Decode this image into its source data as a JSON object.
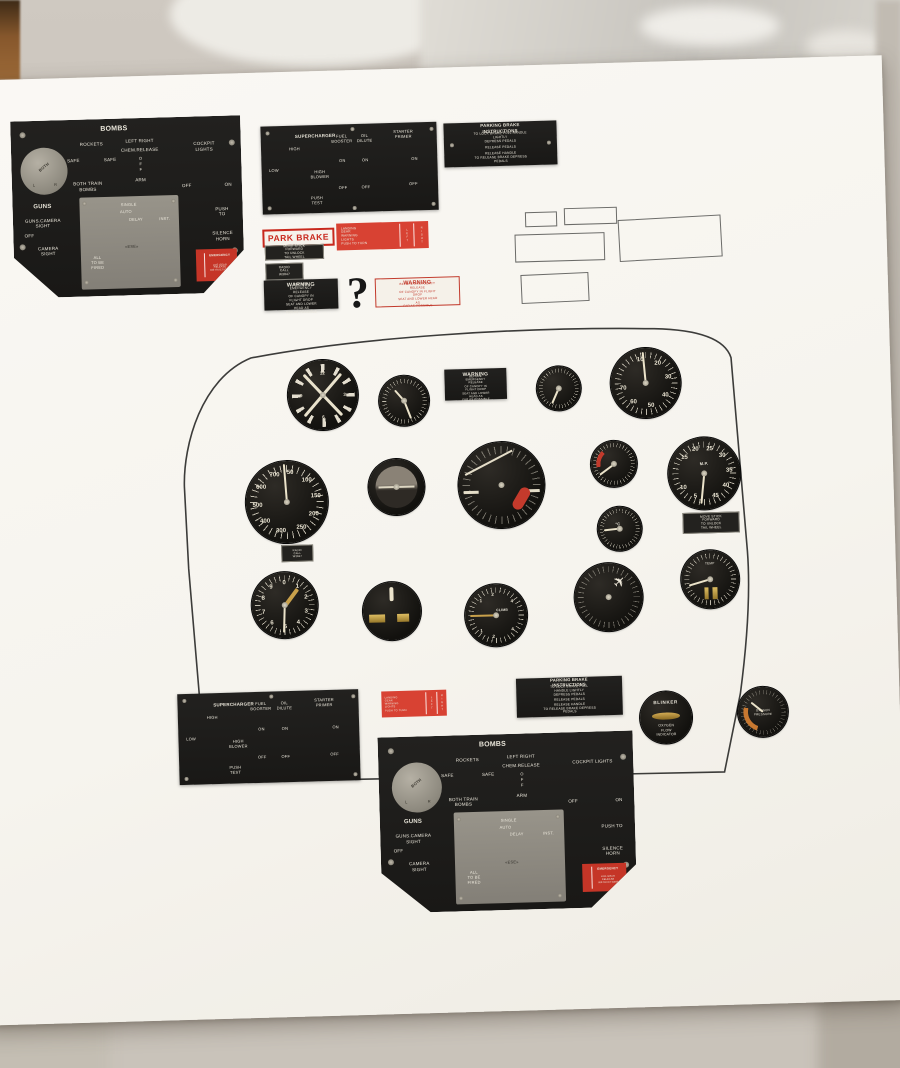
{
  "colors": {
    "panel_black": "#1b1a18",
    "placard_red": "#d84233",
    "warning_red": "#c23a2c",
    "paper": "#f6f4ee",
    "gold": "#c9a14b"
  },
  "labels": {
    "bombs": {
      "title": "BOMBS",
      "rockets": "ROCKETS",
      "left_right": "LEFT    RIGHT",
      "chem_release": "CHEM.RELEASE",
      "cockpit_lights": "COCKPIT LIGHTS",
      "safe_a": "SAFE",
      "safe_b": "SAFE",
      "off_stack": "OFF",
      "arm": "ARM",
      "both_train": "BOTH TRAIN\nBOMBS",
      "off_a": "OFF",
      "on_a": "ON",
      "knob_center": "BOTH",
      "knob_l": "L",
      "knob_r": "R",
      "guns": "GUNS",
      "guns_camera": "GUNS.CAMERA\nSIGHT",
      "off_b": "OFF",
      "camera_sight": "CAMERA\nSIGHT",
      "single": "SINGLE",
      "auto": "AUTO",
      "delay": "DELAY",
      "inst": "INST.",
      "center_mark": "«ESE»",
      "all_fired": "ALL\nTO BE\nFIRED",
      "push_to": "PUSH TO",
      "silence": "SILENCE\nHORN",
      "emergency_title": "EMERGENCY",
      "emergency_lines": "LDG GEAR\nRELEASE\nINSTRUCTIONS"
    },
    "supercharger": {
      "title": "SUPERCHARGER",
      "high": "HIGH",
      "low": "LOW",
      "high_blower": "HIGH\nBLOWER",
      "push_test": "PUSH\nTEST",
      "fuel_booster": "FUEL\nBOOSTER",
      "oil_dilute": "OIL\nDILUTE",
      "starter_primer": "STARTER PRIMER",
      "on": "ON",
      "off": "OFF"
    },
    "parking_brake": {
      "title": "PARKING BRAKE INSTRUCTIONS",
      "lines": [
        "TO LOCK BRAKE PULL HANDLE LIGHTLY",
        "DEPRESS PEDALS",
        "RELEASE PEDALS",
        "RELEASE HANDLE",
        "TO RELEASE BRAKE DEPRESS PEDALS"
      ]
    },
    "park_brake": "PARK BRAKE",
    "tail_wheel": "MOVE STICK FORWARD\nTO UNLOCK TAIL WHEEL",
    "radio_call": "RADIO CALL\nW3847",
    "landing_gear": {
      "lines": "LANDING\nGEAR\nWARNING\nLIGHTS\nPUSH TO TURN",
      "col_left": "LEFT",
      "col_right": "RIGHT"
    },
    "warning": {
      "title": "WARNING",
      "lines": "BEFORE EMERGENCY RELEASE\nOF CANOPY IN FLIGHT DROP\nSEAT AND LOWER HEAD AS\nFAR AS POSSIBLE"
    },
    "question_mark": "?",
    "blinker": {
      "title": "BLINKER",
      "subtitle": "OXYGEN FLOW\nINDICATOR"
    },
    "oxygen_gauge": "OXYGEN\nPRESSURE"
  },
  "gauges": {
    "clock_numbers": [
      {
        "t": "12",
        "a": 0,
        "d": 0.62
      },
      {
        "t": "3",
        "a": 90,
        "d": 0.62
      },
      {
        "t": "6",
        "a": 180,
        "d": 0.62
      },
      {
        "t": "9",
        "a": 270,
        "d": 0.62
      }
    ],
    "tachometer": {
      "numbers": [
        {
          "t": "10",
          "a": -12,
          "d": 0.66
        },
        {
          "t": "20",
          "a": 33,
          "d": 0.66
        },
        {
          "t": "30",
          "a": 78,
          "d": 0.66
        },
        {
          "t": "40",
          "a": 123,
          "d": 0.66
        },
        {
          "t": "50",
          "a": 168,
          "d": 0.66
        },
        {
          "t": "60",
          "a": 213,
          "d": 0.66
        },
        {
          "t": "70",
          "a": 258,
          "d": 0.66
        }
      ]
    },
    "airspeed": {
      "numbers": [
        {
          "t": "50",
          "a": 8,
          "d": 0.72
        },
        {
          "t": "100",
          "a": 44,
          "d": 0.72
        },
        {
          "t": "150",
          "a": 80,
          "d": 0.72
        },
        {
          "t": "200",
          "a": 116,
          "d": 0.72
        },
        {
          "t": "250",
          "a": 152,
          "d": 0.72
        },
        {
          "t": "300",
          "a": 193,
          "d": 0.72
        },
        {
          "t": "400",
          "a": 229,
          "d": 0.72
        },
        {
          "t": "500",
          "a": 265,
          "d": 0.72
        },
        {
          "t": "600",
          "a": 301,
          "d": 0.72
        },
        {
          "t": "700",
          "a": 337,
          "d": 0.72
        }
      ]
    },
    "manifold": {
      "label": "M.P.",
      "numbers": [
        {
          "t": "15",
          "a": -50,
          "d": 0.7
        },
        {
          "t": "20",
          "a": -19,
          "d": 0.7
        },
        {
          "t": "25",
          "a": 14,
          "d": 0.7
        },
        {
          "t": "30",
          "a": 47,
          "d": 0.7
        },
        {
          "t": "35",
          "a": 85,
          "d": 0.7
        },
        {
          "t": "40",
          "a": 122,
          "d": 0.7
        },
        {
          "t": "45",
          "a": 155,
          "d": 0.7
        },
        {
          "t": "5",
          "a": 202,
          "d": 0.7
        },
        {
          "t": "10",
          "a": 237,
          "d": 0.7
        }
      ]
    },
    "altimeter": {
      "numbers": [
        {
          "t": "0",
          "a": 0,
          "d": 0.68
        },
        {
          "t": "1",
          "a": 36,
          "d": 0.68
        },
        {
          "t": "2",
          "a": 72,
          "d": 0.68
        },
        {
          "t": "3",
          "a": 108,
          "d": 0.68
        },
        {
          "t": "4",
          "a": 144,
          "d": 0.68
        },
        {
          "t": "5",
          "a": 180,
          "d": 0.68
        },
        {
          "t": "6",
          "a": 216,
          "d": 0.68
        },
        {
          "t": "7",
          "a": 252,
          "d": 0.68
        },
        {
          "t": "8",
          "a": 288,
          "d": 0.68
        },
        {
          "t": "9",
          "a": 324,
          "d": 0.68
        }
      ]
    },
    "vsi": {
      "label": "CLIMB",
      "numbers": [
        {
          "t": "1",
          "a": 315,
          "d": 0.68
        },
        {
          "t": "2",
          "a": 352,
          "d": 0.68
        },
        {
          "t": "4",
          "a": 50,
          "d": 0.68
        },
        {
          "t": "4",
          "a": 130,
          "d": 0.68
        },
        {
          "t": "2",
          "a": 188,
          "d": 0.68
        },
        {
          "t": "1",
          "a": 225,
          "d": 0.68
        }
      ]
    },
    "carb_temp": {
      "label": "°C"
    },
    "engine": {
      "label": "TEMP"
    }
  }
}
